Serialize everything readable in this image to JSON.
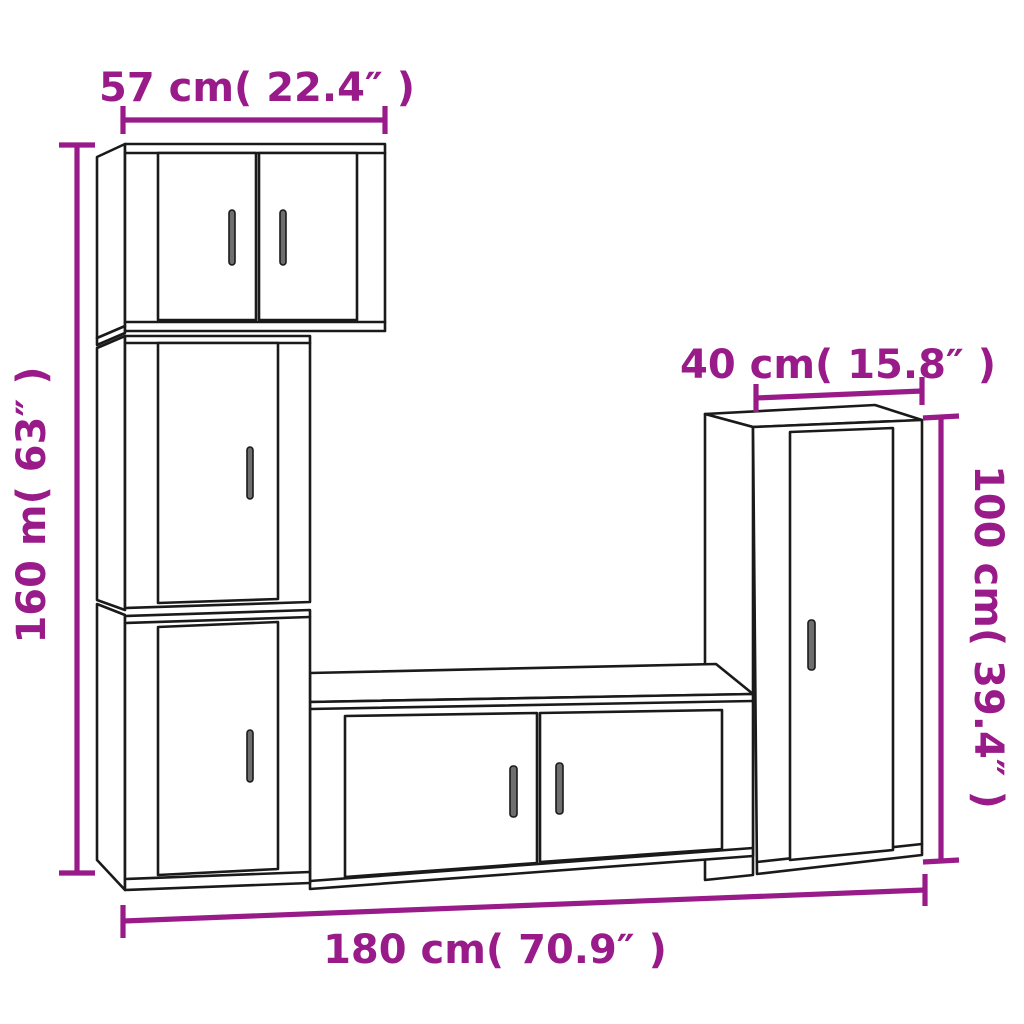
{
  "colors": {
    "dimension": "#981b89",
    "line": "#1a1a1a",
    "background": "#ffffff",
    "handle_fill": "#6e6e6e"
  },
  "dimensions": {
    "top_width": {
      "label": "57 cm( 22.4″ )",
      "value_cm": 57,
      "value_in": 22.4
    },
    "left_height": {
      "label": "160 m( 63″ )",
      "value_cm": 160,
      "value_in": 63
    },
    "right_depth": {
      "label": "40 cm( 15.8″ )",
      "value_cm": 40,
      "value_in": 15.8
    },
    "right_height": {
      "label": "100 cm( 39.4″ )",
      "value_cm": 100,
      "value_in": 39.4
    },
    "bottom_width": {
      "label": "180 cm( 70.9″ )",
      "value_cm": 180,
      "value_in": 70.9
    }
  },
  "pieces": [
    {
      "name": "wall-cabinet-top",
      "doors": 2
    },
    {
      "name": "wall-cabinet-middle",
      "doors": 1
    },
    {
      "name": "wall-cabinet-bottom",
      "doors": 1
    },
    {
      "name": "tv-stand",
      "doors": 2
    },
    {
      "name": "cabinet-right-tall",
      "doors": 1
    }
  ]
}
